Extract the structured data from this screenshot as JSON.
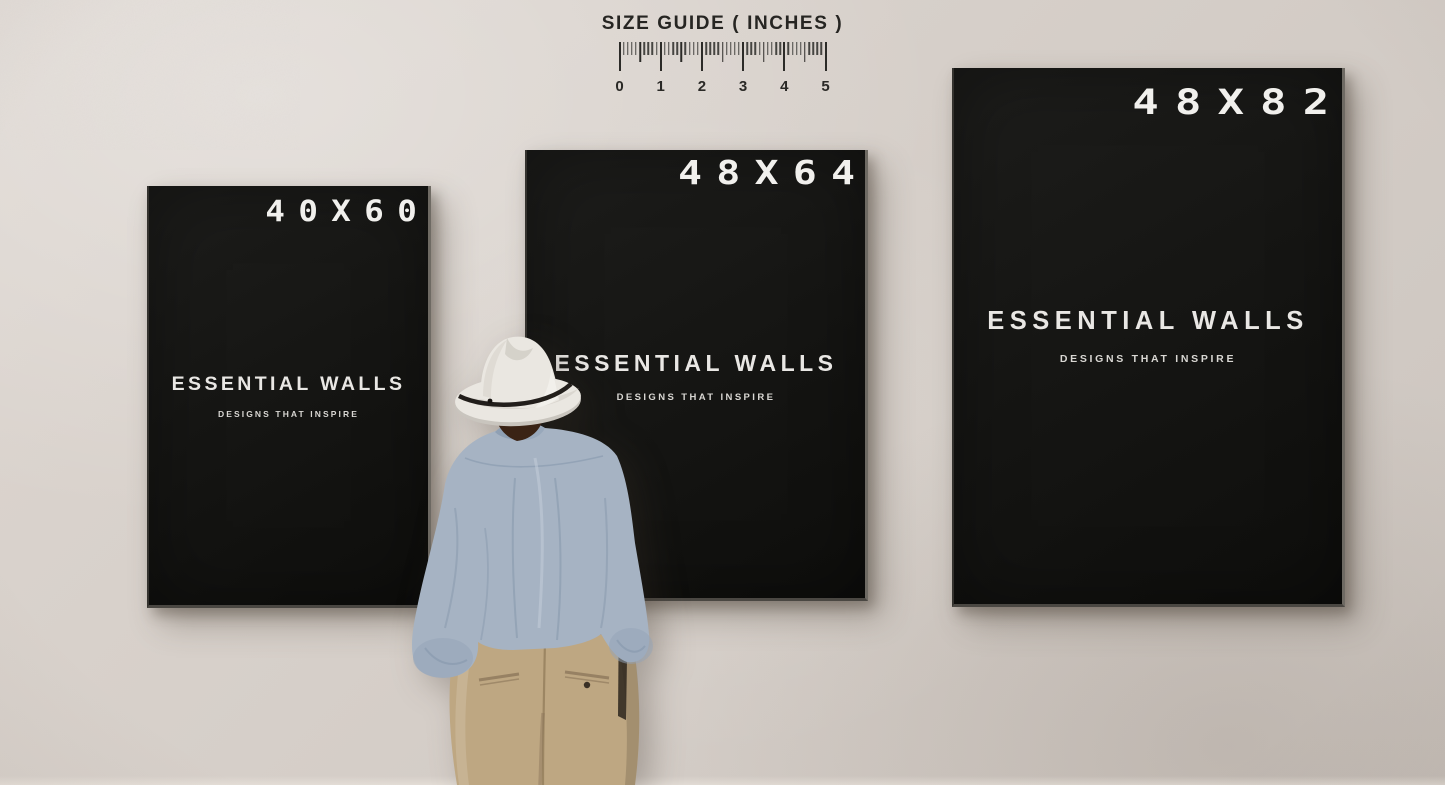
{
  "size_guide": {
    "title": "SIZE GUIDE ( INCHES )",
    "tick_labels": [
      "0",
      "1",
      "2",
      "3",
      "4",
      "5"
    ],
    "minor_ticks_per_unit": 10
  },
  "posters": [
    {
      "size_label": "40X60",
      "brand": "ESSENTIAL WALLS",
      "tagline": "DESIGNS THAT INSPIRE"
    },
    {
      "size_label": "48X64",
      "brand": "ESSENTIAL WALLS",
      "tagline": "DESIGNS THAT INSPIRE"
    },
    {
      "size_label": "48X82",
      "brand": "ESSENTIAL WALLS",
      "tagline": "DESIGNS THAT INSPIRE"
    }
  ],
  "colors": {
    "wall": "#d6cfc9",
    "poster_background": "#161614",
    "poster_text": "#eae8e5",
    "ruler_ink": "#2c2b28",
    "hat": "#eae7e1",
    "hat_band": "#171310",
    "shirt": "#a6b3c3",
    "pants": "#bea782",
    "hair": "#3a2315"
  }
}
